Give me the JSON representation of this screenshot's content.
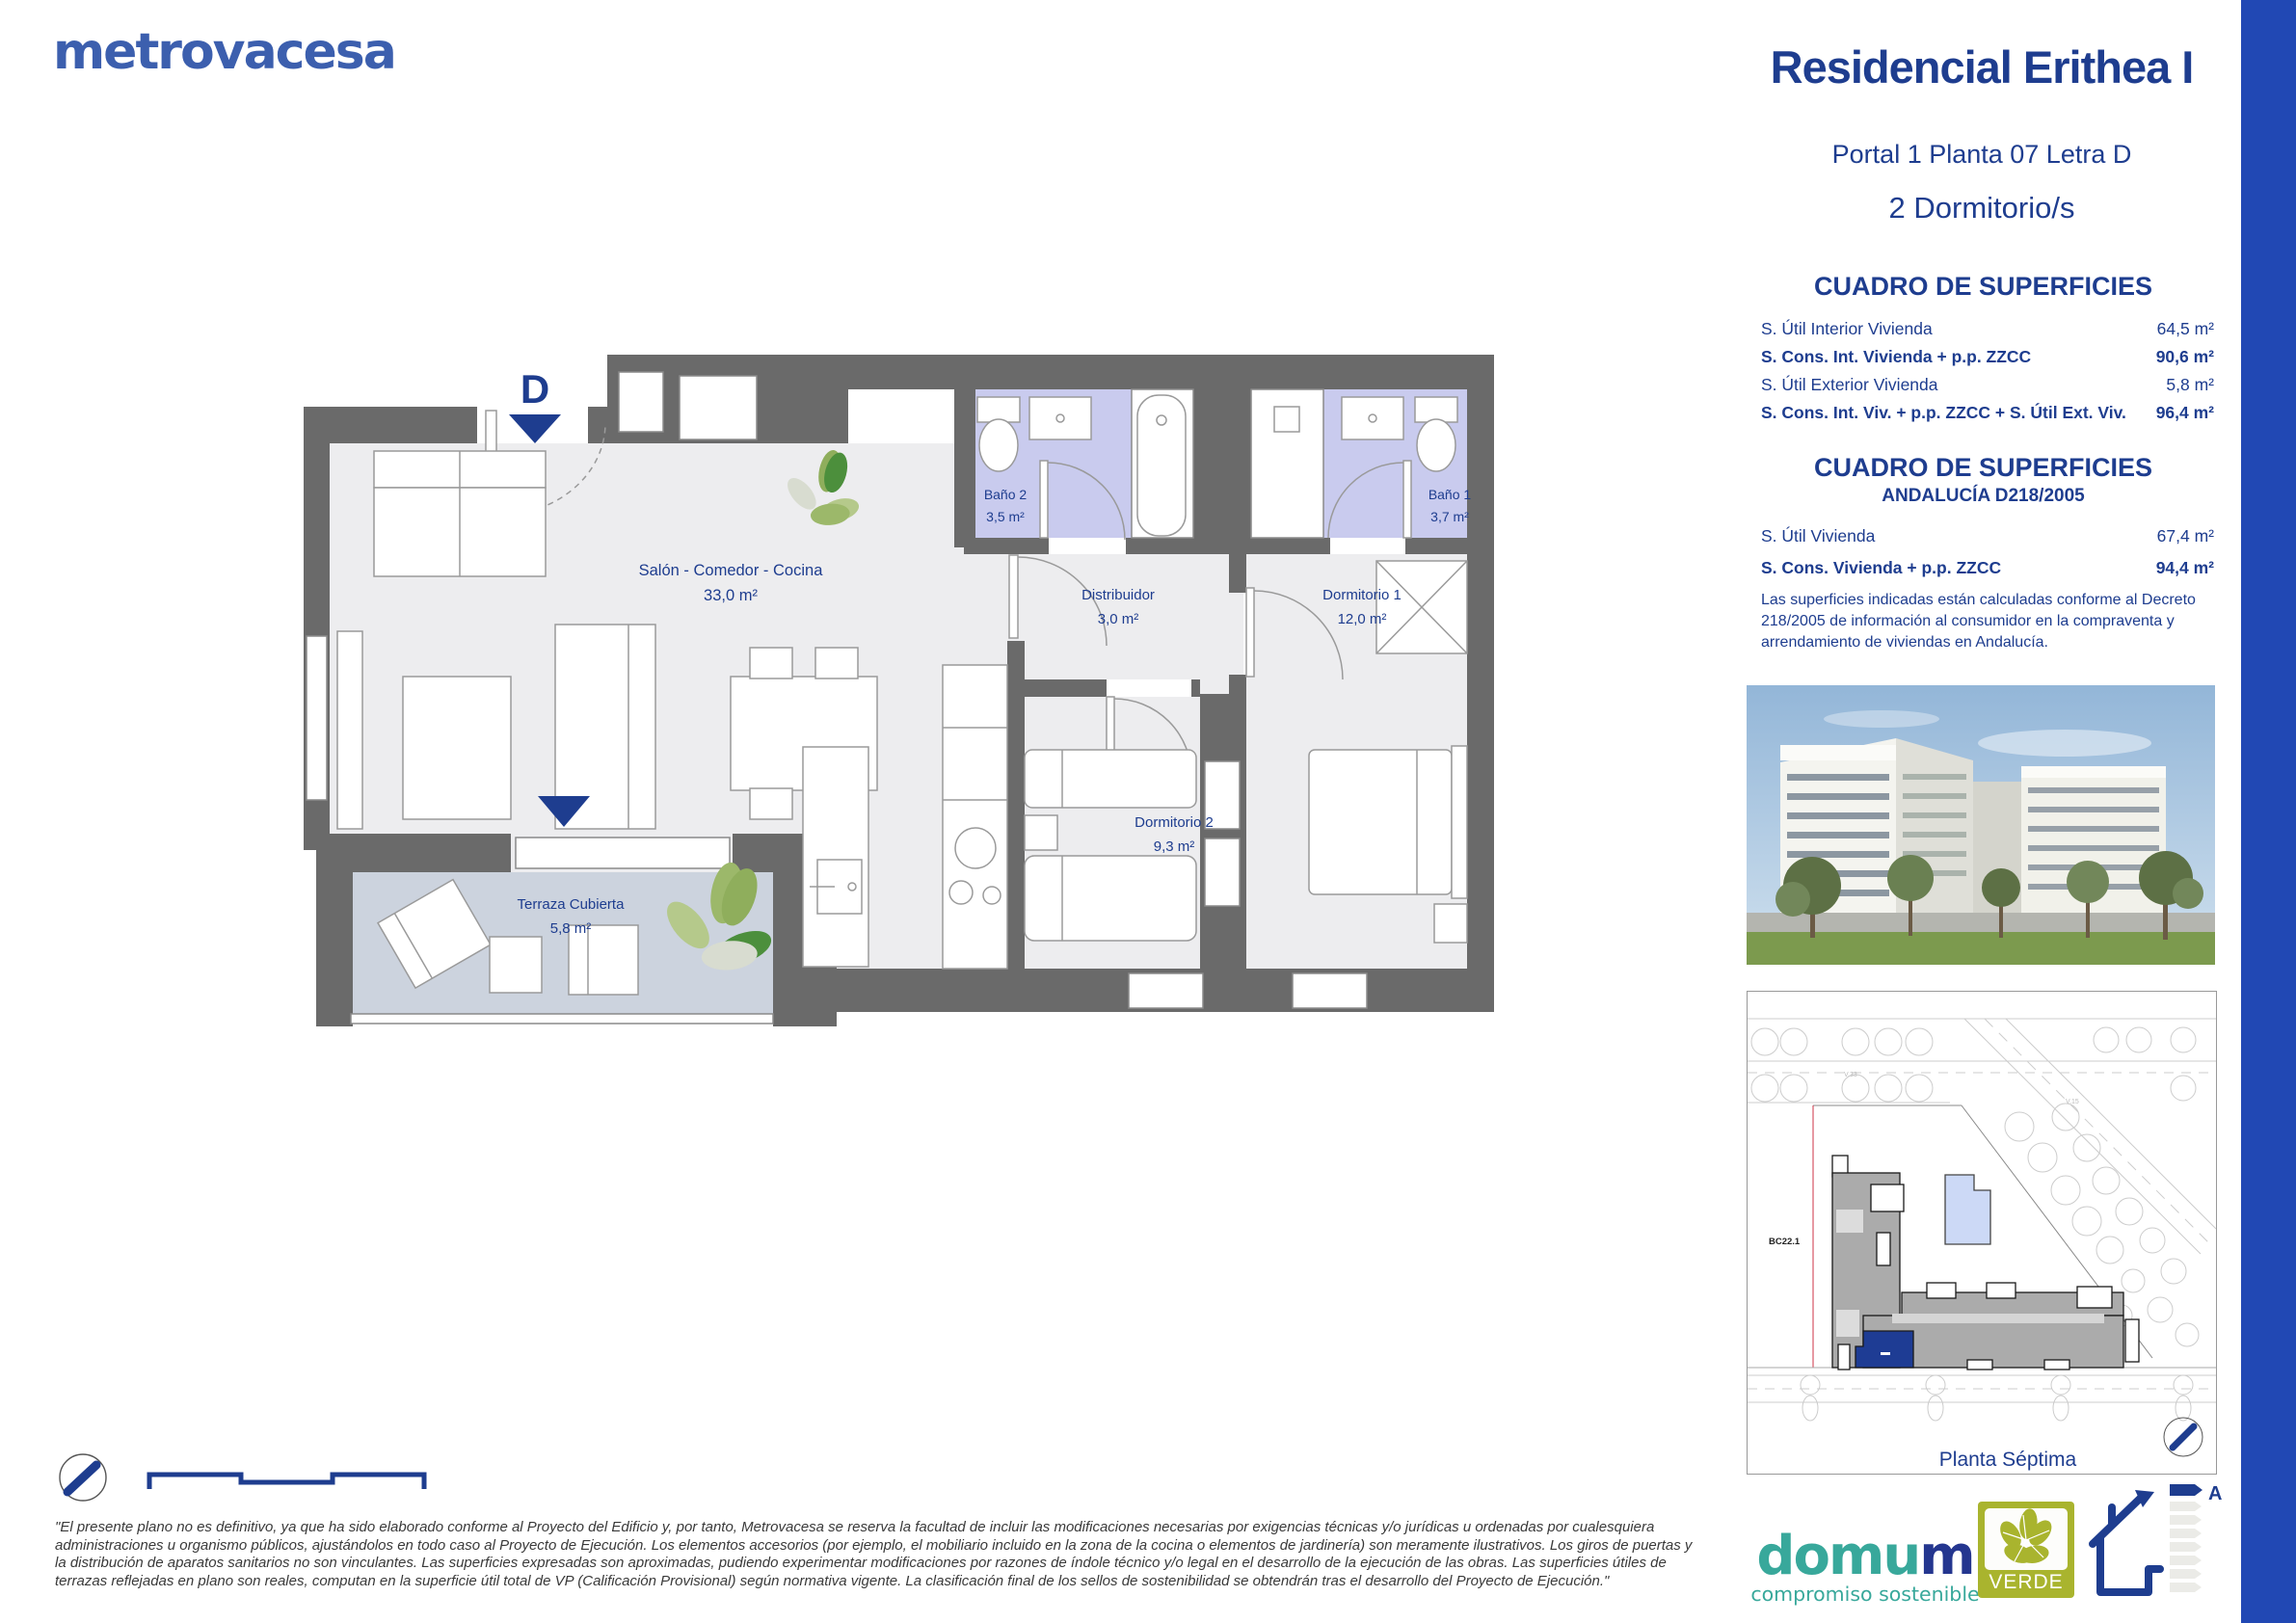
{
  "brand": {
    "logo_text": "metrovacesa"
  },
  "header": {
    "title": "Residencial Erithea I",
    "subtitle": "Portal 1 Planta 07 Letra D",
    "bedrooms": "2 Dormitorio/s"
  },
  "surfaces_table": {
    "title": "CUADRO DE SUPERFICIES",
    "rows": [
      {
        "label": "S. Útil Interior Vivienda",
        "value": "64,5 m²"
      },
      {
        "label": "S. Cons. Int. Vivienda + p.p. ZZCC",
        "value": "90,6 m²"
      },
      {
        "label": "S. Útil Exterior Vivienda",
        "value": "5,8 m²"
      },
      {
        "label": "S. Cons. Int. Viv. + p.p. ZZCC + S. Útil Ext. Viv.",
        "value": "96,4 m²"
      }
    ]
  },
  "andalucia_table": {
    "title": "CUADRO DE SUPERFICIES",
    "subtitle": "ANDALUCÍA D218/2005",
    "rows": [
      {
        "label": "S. Útil Vivienda",
        "value": "67,4 m²"
      },
      {
        "label": "S. Cons. Vivienda + p.p. ZZCC",
        "value": "94,4 m²"
      }
    ],
    "note": "Las superficies indicadas están calculadas conforme al Decreto 218/2005 de información al consumidor en la compraventa y arrendamiento de viviendas en Andalucía."
  },
  "floorplan": {
    "unit_letter": "D",
    "rooms": {
      "salon": {
        "name": "Salón - Comedor - Cocina",
        "area": "33,0 m²"
      },
      "bano2": {
        "name": "Baño 2",
        "area": "3,5 m²"
      },
      "bano1": {
        "name": "Baño 1",
        "area": "3,7 m²"
      },
      "distribuidor": {
        "name": "Distribuidor",
        "area": "3,0 m²"
      },
      "dorm1": {
        "name": "Dormitorio 1",
        "area": "12,0 m²"
      },
      "dorm2": {
        "name": "Dormitorio 2",
        "area": "9,3 m²"
      },
      "terraza": {
        "name": "Terraza Cubierta",
        "area": "5,8 m²"
      }
    }
  },
  "siteplan": {
    "caption": "Planta Séptima",
    "block_label": "BC22.1",
    "road_label_1": "V.33",
    "road_label_2": "V.15"
  },
  "logos": {
    "domum_part1": "domu",
    "domum_part2": "m",
    "domum_tagline": "compromiso sostenible",
    "verde_label": "VERDE",
    "energy_rating": "A"
  },
  "footer": {
    "disclaimer": "\"El presente plano no es definitivo, ya que ha sido elaborado conforme al Proyecto del Edificio y, por tanto, Metrovacesa se reserva la facultad de incluir las modificaciones necesarias por exigencias técnicas y/o jurídicas u ordenadas por cualesquiera administraciones u organismo públicos, ajustándolos en todo caso al Proyecto de Ejecución. Los elementos accesorios (por ejemplo, el mobiliario incluido en la zona de la cocina o elementos de jardinería) son meramente ilustrativos. Los giros de puertas y la distribución de aparatos sanitarios no son vinculantes. Las superficies expresadas son aproximadas, pudiendo experimentar modificaciones por razones de índole técnico y/o legal en el desarrollo de la ejecución de las obras. Las superficies útiles de terrazas reflejadas en plano son reales, computan en la superficie útil total de VP (Calificación Provisional) según normativa vigente. La clasificación final de los sellos de sostenibilidad se obtendrán tras el desarrollo del Proyecto de Ejecución.\""
  },
  "colors": {
    "navy": "#1e3d8f",
    "brand_blue": "#3c5fae",
    "sidebar_blue": "#2148b4",
    "wall_gray": "#6a6a6a",
    "bath_lavender": "#c9cbee",
    "terrace_gray": "#ccd3de",
    "domum_teal": "#38a89b",
    "verde_olive": "#a9b42e"
  }
}
